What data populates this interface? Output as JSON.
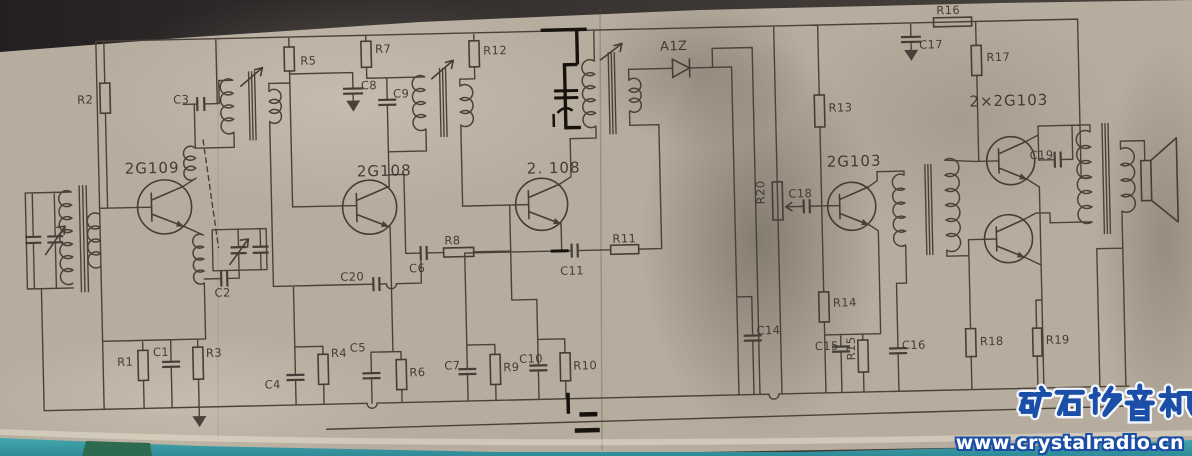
{
  "watermark": {
    "title": "矿石收音机",
    "url": "www.crystalradio.cn"
  },
  "schematic": {
    "transistors": {
      "q1": "2G109",
      "q2": "2G108",
      "q3": "2. 108",
      "q4": "2G103",
      "q5": "2×2G103"
    },
    "diode": "A1Z",
    "resistors": {
      "r1": "R1",
      "r2": "R2",
      "r3": "R3",
      "r4": "R4",
      "r5": "R5",
      "r6": "R6",
      "r7": "R7",
      "r8": "R8",
      "r9": "R9",
      "r10": "R10",
      "r11": "R11",
      "r12": "R12",
      "r13": "R13",
      "r14": "R14",
      "r15": "R15",
      "r16": "R16",
      "r17": "R17",
      "r18": "R18",
      "r19": "R19",
      "r20": "R20"
    },
    "capacitors": {
      "c1": "C1",
      "c2": "C2",
      "c3": "C3",
      "c4": "C4",
      "c5": "C5",
      "c6": "C6",
      "c7": "C7",
      "c8": "C8",
      "c9": "C9",
      "c10": "C10",
      "c11": "C11",
      "c14": "C14",
      "c15": "C15",
      "c16": "C16",
      "c17": "C17",
      "c18": "C18",
      "c19": "C19",
      "c20": "C20"
    }
  }
}
